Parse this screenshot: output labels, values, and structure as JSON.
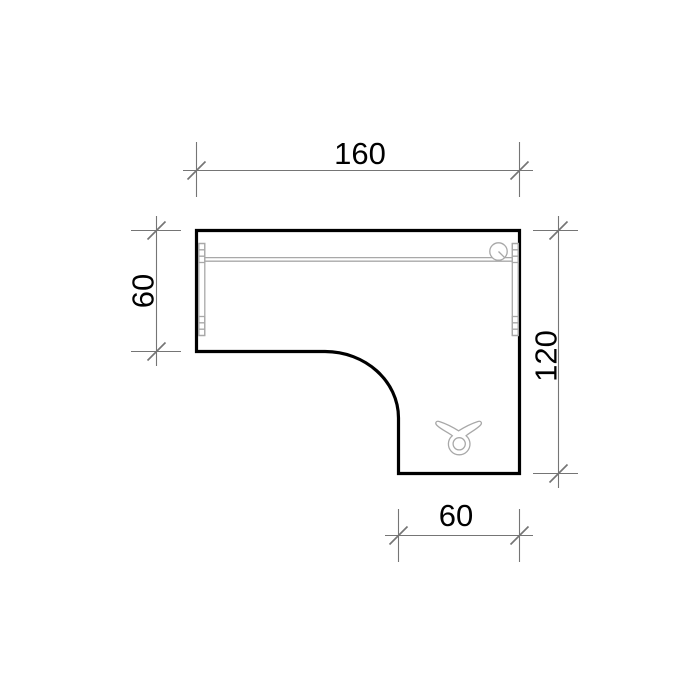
{
  "drawing": {
    "type": "desk-plan-view",
    "dimensions": {
      "top_width": {
        "label": "160"
      },
      "left_depth": {
        "label": "60"
      },
      "right_depth": {
        "label": "120"
      },
      "bottom_width": {
        "label": "60"
      }
    },
    "icons": [
      {
        "name": "cable-grommet-icon"
      },
      {
        "name": "wing-knob-icon"
      },
      {
        "name": "left-leg-mount"
      },
      {
        "name": "right-leg-mount"
      }
    ],
    "colors": {
      "background": "#ffffff",
      "outline": "#000000",
      "dimension": "#757575",
      "detail": "#a8a8a8",
      "label": "#000000"
    }
  }
}
